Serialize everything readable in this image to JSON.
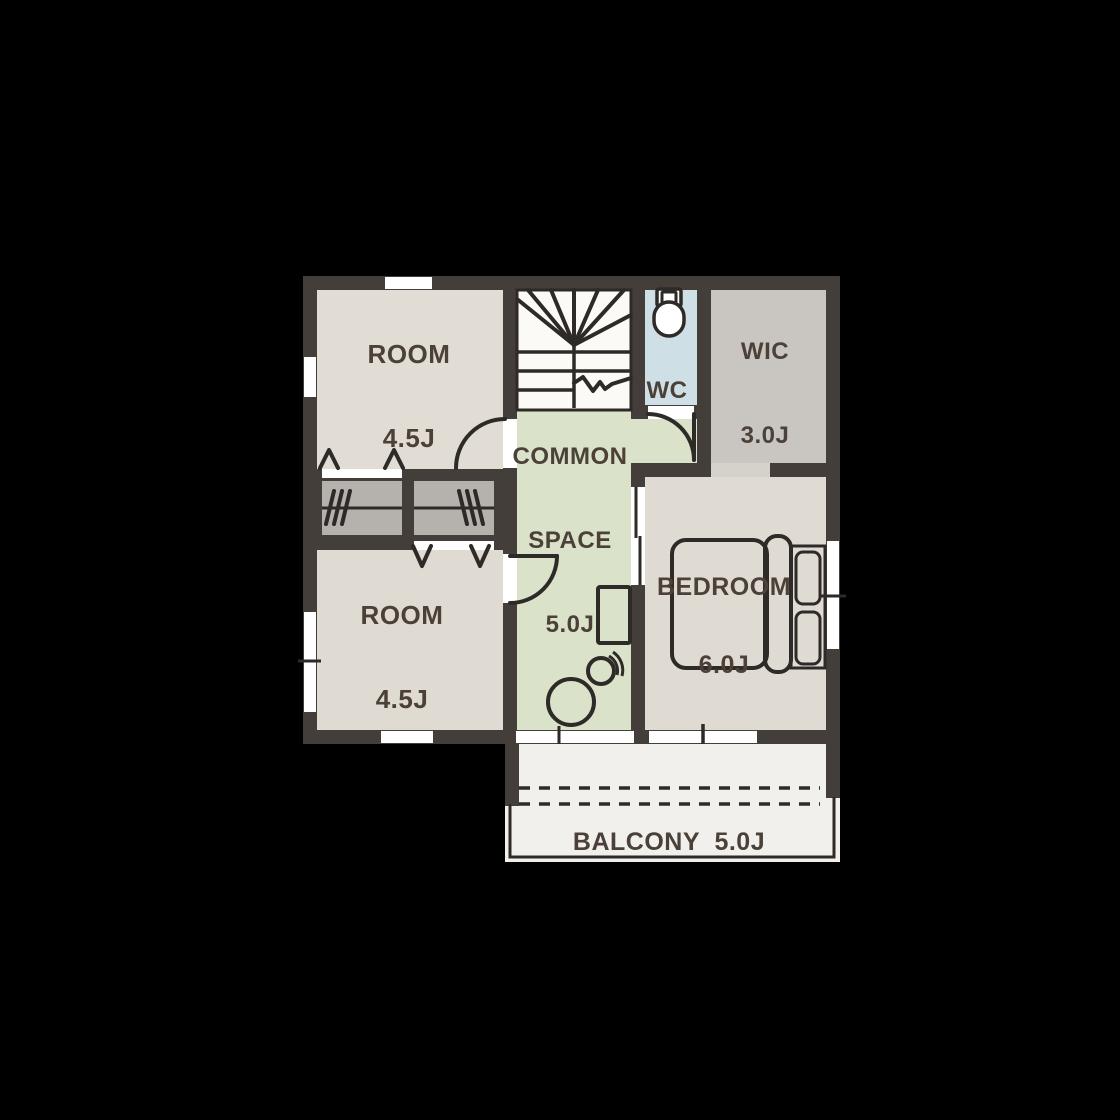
{
  "floorplan": {
    "rooms": {
      "room_top_left": {
        "name": "ROOM",
        "area": "4.5J"
      },
      "room_bottom_left": {
        "name": "ROOM",
        "area": "4.5J"
      },
      "common_space": {
        "name_line1": "COMMON",
        "name_line2": "SPACE",
        "area": "5.0J"
      },
      "wc": {
        "name": "WC"
      },
      "wic": {
        "name": "WIC",
        "area": "3.0J"
      },
      "bedroom": {
        "name": "BEDROOM",
        "area": "6.0J"
      },
      "balcony": {
        "name": "BALCONY",
        "area": "5.0J",
        "label": "BALCONY  5.0J"
      }
    },
    "fixtures": [
      "staircase",
      "toilet",
      "closet-left",
      "closet-right",
      "bed",
      "desk",
      "round-table",
      "chair"
    ],
    "colors": {
      "background": "#000000",
      "wall": "#443e3a",
      "room": "#e1ddd5",
      "room2": "#dfdbd3",
      "stairs": "#fbfaf7",
      "wc": "#cfdfe6",
      "wic": "#c9c6c2",
      "common": "#dae2ca",
      "bedroom": "#dfdbd3",
      "closet": "#b5b2ad",
      "balcony": "#f1f0ed",
      "opening": "#d5d2cc",
      "line": "#2e2a27",
      "window": "#ffffff",
      "text": "#4b4138"
    }
  }
}
